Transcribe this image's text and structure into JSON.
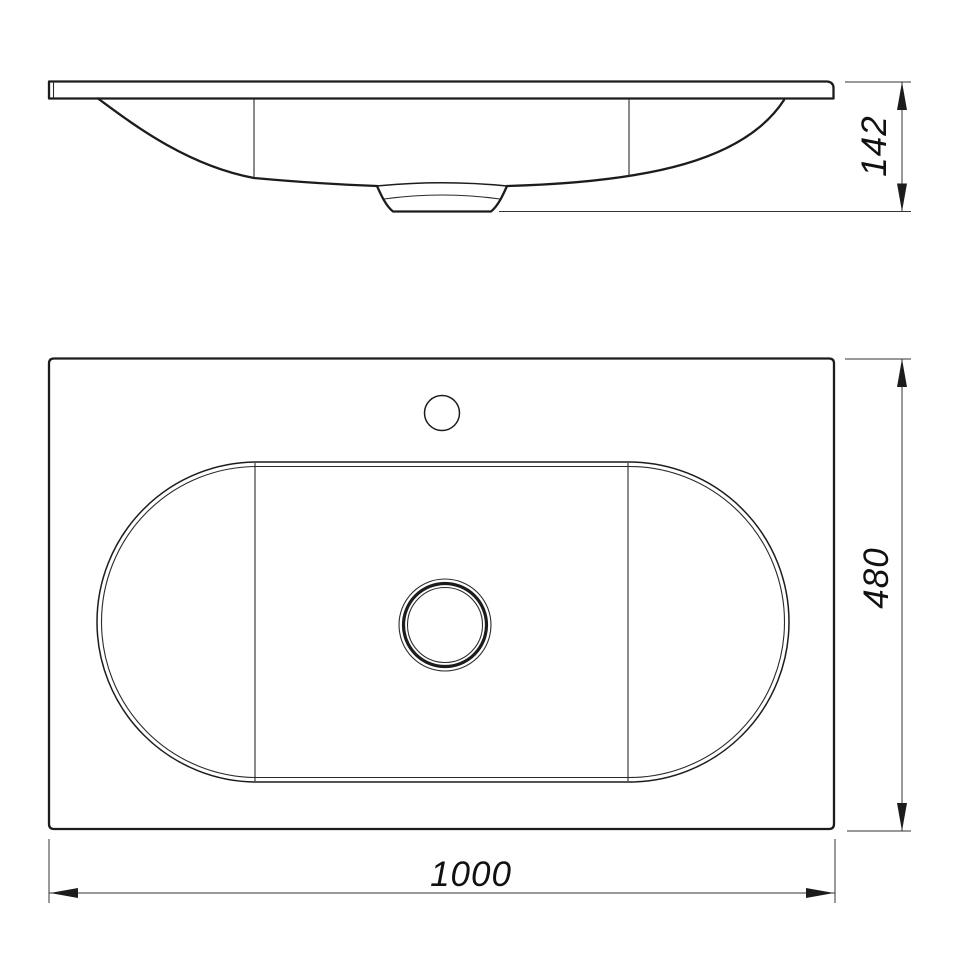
{
  "colors": {
    "background": "#ffffff",
    "line": "#1c1c1c"
  },
  "views": {
    "side_view": {
      "dimension_height": "142"
    },
    "plan_view": {
      "dimension_depth": "480",
      "dimension_width": "1000"
    }
  }
}
